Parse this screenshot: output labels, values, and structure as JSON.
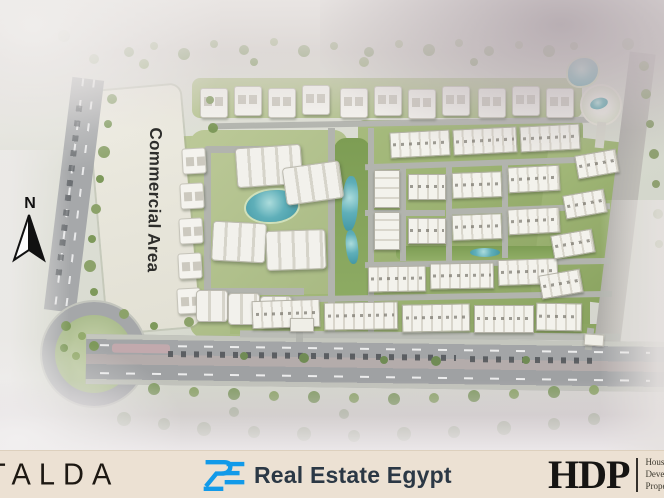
{
  "plan": {
    "commercial_area_label": "Commercial Area",
    "north_label": "N"
  },
  "footer": {
    "talda_label": "TALDA",
    "realestate_label": "Real Estate Egypt",
    "hdp_label": "HDP",
    "hdp_tagline": [
      "Housing and",
      "Development",
      "Properties"
    ]
  },
  "colors": {
    "footer_background": "#ece1d3",
    "realestate_blue": "#129ae9",
    "water_teal": "#4fa8b4",
    "greenery": "#8fae63",
    "road_grey": "#a6a8aa",
    "building_white": "#f3f2ec",
    "logo_dark": "#1d1812"
  }
}
